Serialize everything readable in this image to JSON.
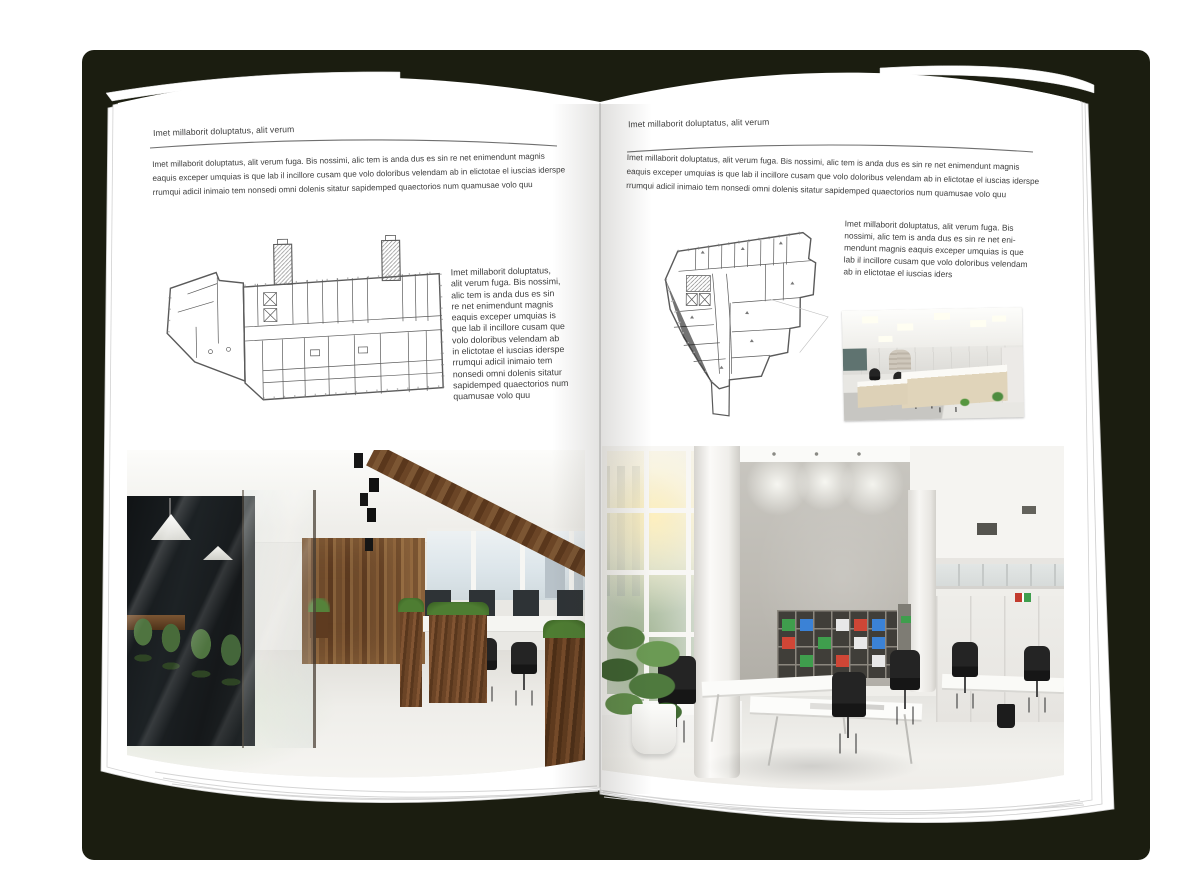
{
  "colors": {
    "backdrop": "#1b1d10",
    "page": "#ffffff",
    "text": "#3e3e3e",
    "rule": "#6f6f6f",
    "floorplan_line": "#5a5a5a",
    "wood": "#6e4a2b",
    "plant_green": "#4e7d32",
    "binder_green": "#3f9e4d",
    "binder_blue": "#3b82d6",
    "binder_red": "#cf4636"
  },
  "left_page": {
    "header": "Imet millaborit doluptatus, alit verum",
    "intro": "Imet millaborit doluptatus, alit verum fuga. Bis nossimi, alic tem is anda dus es sin re net enimendunt magnis\neaquis exceper umquias is que lab il incillore cusam que volo doloribus velendam ab in elictotae el iuscias iderspe\nrrumqui adicil inimaio tem nonsedi omni dolenis sitatur sapidemped quaectorios num quamusae volo quu",
    "caption": "Imet millaborit doluptatus,\nalit verum fuga. Bis nossimi,\nalic tem is anda dus es sin\nre net enimendunt magnis\neaquis exceper umquias is\nque lab il incillore cusam que\nvolo doloribus velendam ab\nin elictotae el iuscias iderspe\nrrumqui adicil inimaio tem\nnonsedi omni dolenis sitatur\nsapidemped quaectorios num\nquamusae volo quu"
  },
  "right_page": {
    "header": "Imet millaborit doluptatus, alit verum",
    "intro": "Imet millaborit doluptatus, alit verum fuga. Bis nossimi, alic tem is anda dus es sin re net enimendunt magnis\neaquis exceper umquias is que lab il incillore cusam que volo doloribus velendam ab in elictotae el iuscias iderspe\nrrumqui adicil inimaio tem nonsedi omni dolenis sitatur sapidemped quaectorios num quamusae volo quu",
    "caption": "Imet millaborit doluptatus, alit verum fuga. Bis\nnossimi, alic tem is anda dus es sin re net eni-\nmendunt magnis eaquis exceper umquias is que\nlab il incillore cusam que volo doloribus velendam\nab in elictotae el iuscias iders"
  }
}
